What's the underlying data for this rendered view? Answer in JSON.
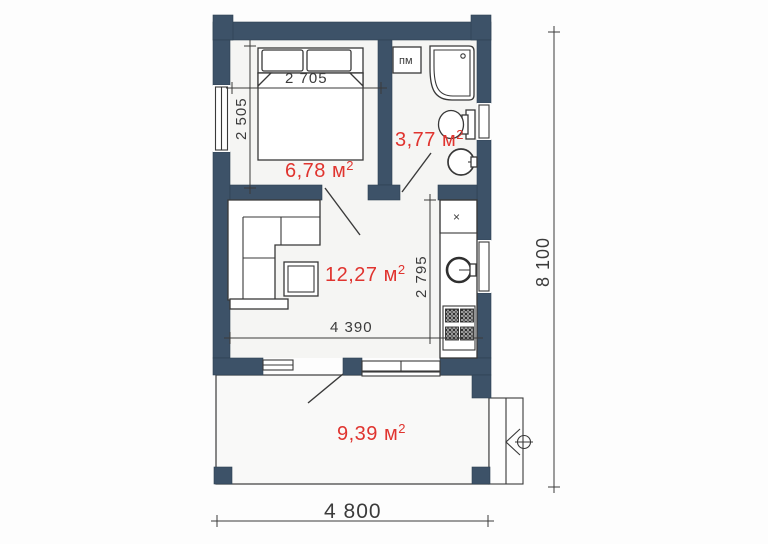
{
  "plan": {
    "rooms": {
      "bedroom": {
        "area": "6,78 м",
        "sup": "2"
      },
      "bathroom": {
        "area": "3,77 м",
        "sup": "2",
        "washer_label": "пм"
      },
      "living": {
        "area": "12,27 м",
        "sup": "2",
        "cabinet_label": "×"
      },
      "terrace": {
        "area": "9,39 м",
        "sup": "2"
      }
    },
    "dims": {
      "bed_width": "2 705",
      "bedroom_depth": "2 505",
      "kitchen_depth": "2 795",
      "living_width": "4 390",
      "overall_depth": "8 100",
      "overall_width": "4 800"
    },
    "colors": {
      "wall": "#3d5268",
      "area_text": "#e0342f",
      "line": "#3a3a3a"
    },
    "icons": [
      "double-bed",
      "pillow",
      "corner-sofa",
      "coffee-table",
      "kitchen-counter",
      "kitchen-sink",
      "stove",
      "washing-machine",
      "corner-bathtub",
      "toilet",
      "washbasin",
      "entrance-steps",
      "entrance-arrow",
      "door-leaf",
      "window"
    ]
  }
}
